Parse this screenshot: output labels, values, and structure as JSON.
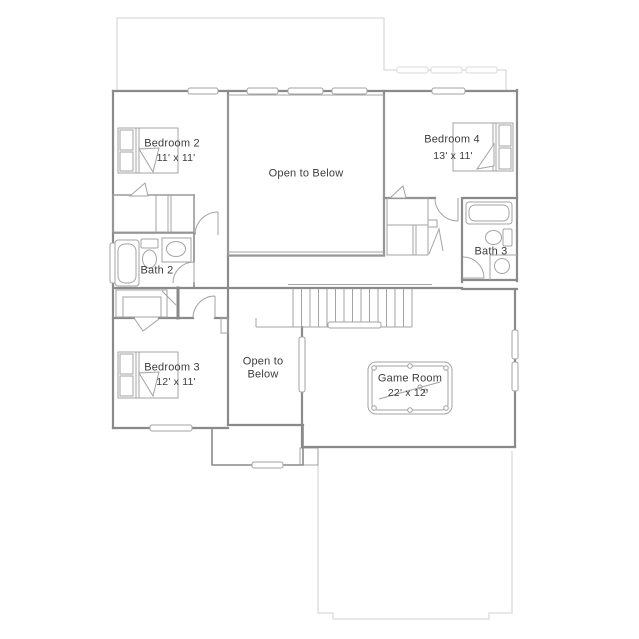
{
  "labels": {
    "bedroom2": {
      "name": "Bedroom 2",
      "dims": "11' x 11'"
    },
    "open_to_below_main": {
      "name": "Open to Below"
    },
    "bedroom4": {
      "name": "Bedroom 4",
      "dims": "13' x 11'"
    },
    "bath2": {
      "name": "Bath 2"
    },
    "bath3": {
      "name": "Bath 3"
    },
    "bedroom3": {
      "name": "Bedroom 3",
      "dims": "12' x 11'"
    },
    "open_to_below_small": {
      "line1": "Open to",
      "line2": "Below"
    },
    "game_room": {
      "name": "Game Room",
      "dims": "22' x 12'"
    }
  },
  "colors": {
    "wall": "#8a8a8a",
    "thin_line": "#a3a3a3",
    "roofline": "#dadada",
    "text": "#3c3c3c",
    "background": "#ffffff"
  }
}
